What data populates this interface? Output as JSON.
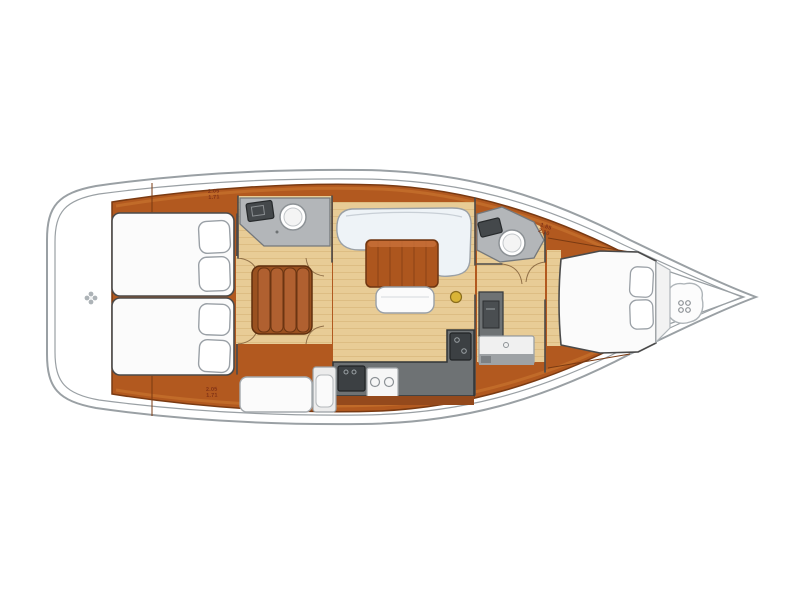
{
  "colors": {
    "background": "#ffffff",
    "hull_line": "#9aa0a4",
    "wood": "#b2591f",
    "wood_dark": "#7a3a12",
    "wood_light": "#c9752f",
    "floor": "#e8cc96",
    "floor_line": "#d8b67a",
    "counter_gray": "#b3b6b9",
    "counter_dark": "#6e7274",
    "appliance_dark": "#44484b",
    "furniture_white": "#fbfbfb",
    "furniture_outline": "#9aa0a6",
    "settee": "#eef3f7",
    "wall_line": "#4a4a4a",
    "mast_gold": "#d9b436",
    "dim_text": "#7d2f15"
  },
  "labels": {
    "aft_port_dim": {
      "line1": "2.05",
      "line2": "1.71"
    },
    "aft_starboard_dim": {
      "line1": "2.05",
      "line2": "1.71"
    },
    "forward_dim": {
      "line1": "1.85",
      "line2": "2.10"
    }
  }
}
